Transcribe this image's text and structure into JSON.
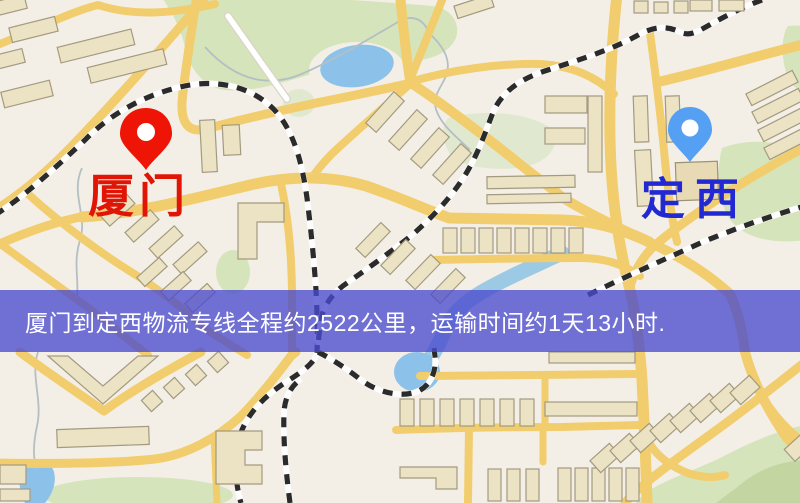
{
  "window": {
    "width": 800,
    "height": 503
  },
  "map": {
    "markers": [
      {
        "id": "origin",
        "label": "厦门",
        "pin_color": "#ee1506",
        "label_color": "#e01505"
      },
      {
        "id": "destination",
        "label": "定西",
        "pin_color": "#55a0f2",
        "label_color": "#2329d2"
      }
    ],
    "banner": {
      "text": "厦门到定西物流专线全程约2522公里，运输时间约1天13小时.",
      "background_rgba": "rgba(74,76,206,0.78)",
      "text_color": "#ffffff"
    }
  },
  "palette": {
    "map_background": "#f4efe6",
    "road_yellow": "#f2cd6d",
    "park_green": "#d5e4ba",
    "water_blue": "#8cc2ea",
    "building_fill": "#ece2c4",
    "railway_dash": "#2b2b2b"
  }
}
